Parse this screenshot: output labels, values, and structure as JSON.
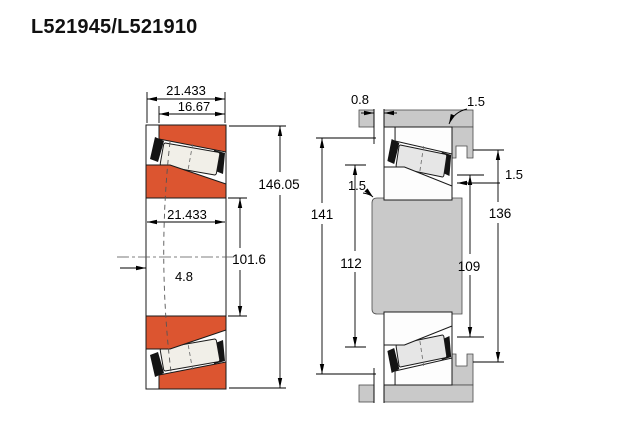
{
  "title": "L521945/L521910",
  "colors": {
    "bearing_orange": "#dc5530",
    "steel_gray": "#c9c9c9",
    "ring_white": "#fdfdfd",
    "roller_beige": "#f1efe8",
    "roller_gray": "#e6e6e6",
    "outline": "#1a1a1a"
  },
  "left_view": {
    "labels": {
      "overall_width": "21.433",
      "cup_width": "16.67",
      "outer_diameter": "146.05",
      "bore_width": "21.433",
      "bore_diameter": "101.6",
      "center_offset": "4.8"
    }
  },
  "right_view": {
    "labels": {
      "backface_clearance": "0.8",
      "housing_fillet_radius": "1.5",
      "shaft_fillet_radius": "1.5",
      "cup_front_radius": "1.5",
      "housing_outer_diameter": "141",
      "shaft_abutment_diameter": "112",
      "cone_backface_diameter": "109",
      "housing_abutment_diameter": "136"
    }
  }
}
